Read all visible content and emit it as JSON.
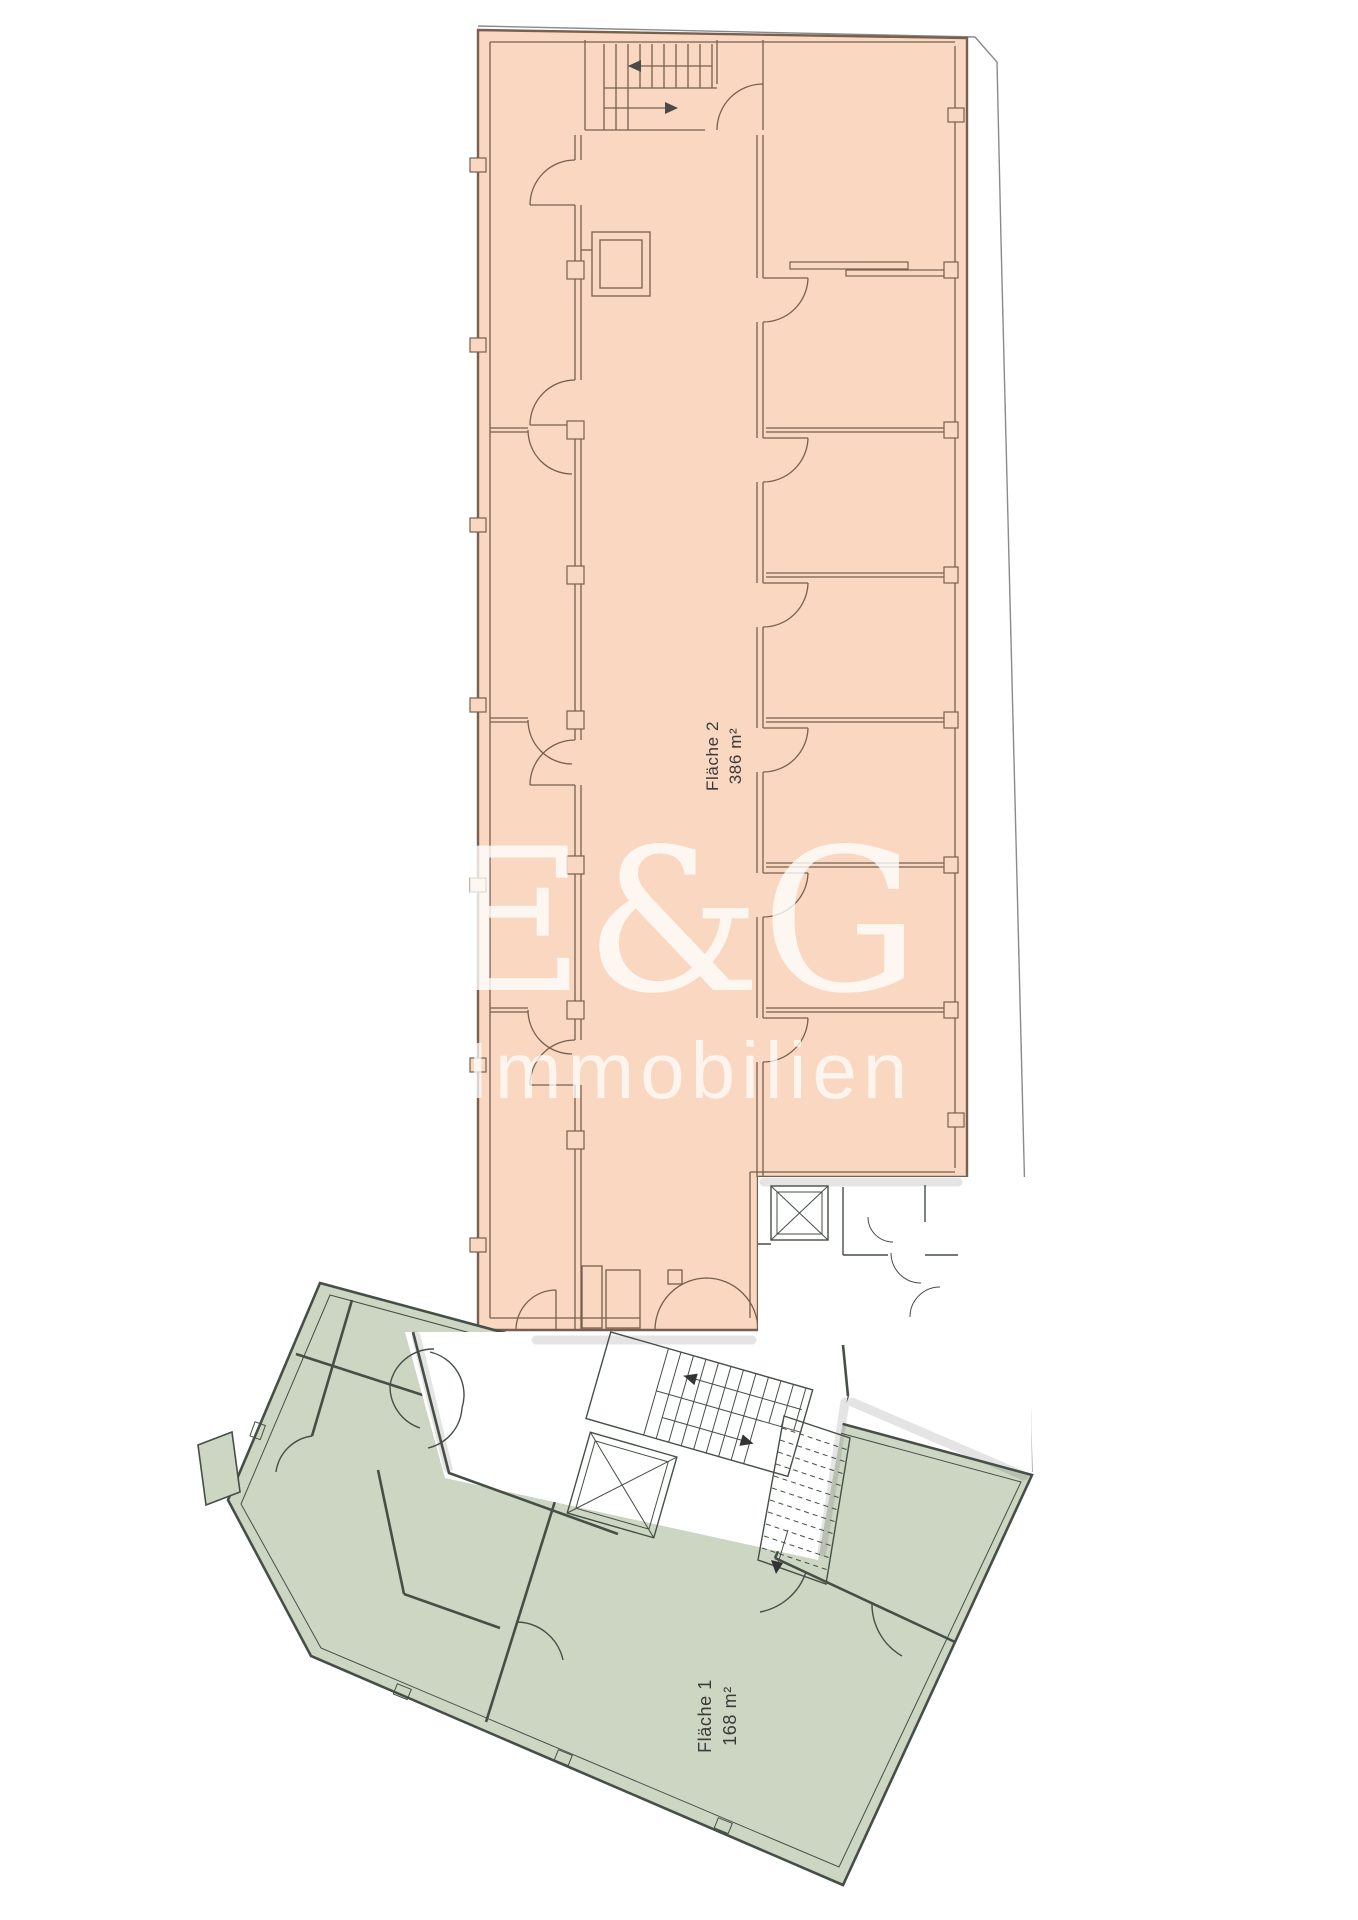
{
  "labels": {
    "area2": {
      "name": "Fläche 2",
      "size": "386 m²"
    },
    "area1": {
      "name": "Fläche 1",
      "size": "168 m²"
    }
  },
  "watermark": {
    "brand": "E&G",
    "subtitle": "Immobilien"
  },
  "colors": {
    "area2_fill": "#f9d7c0",
    "area1_fill": "#cdd5c3",
    "area2_wall": "#77604f",
    "area1_wall": "#454f46",
    "boundary": "#8a8a8a",
    "label_text": "#3a3a3a",
    "watermark": "#ffffff"
  }
}
